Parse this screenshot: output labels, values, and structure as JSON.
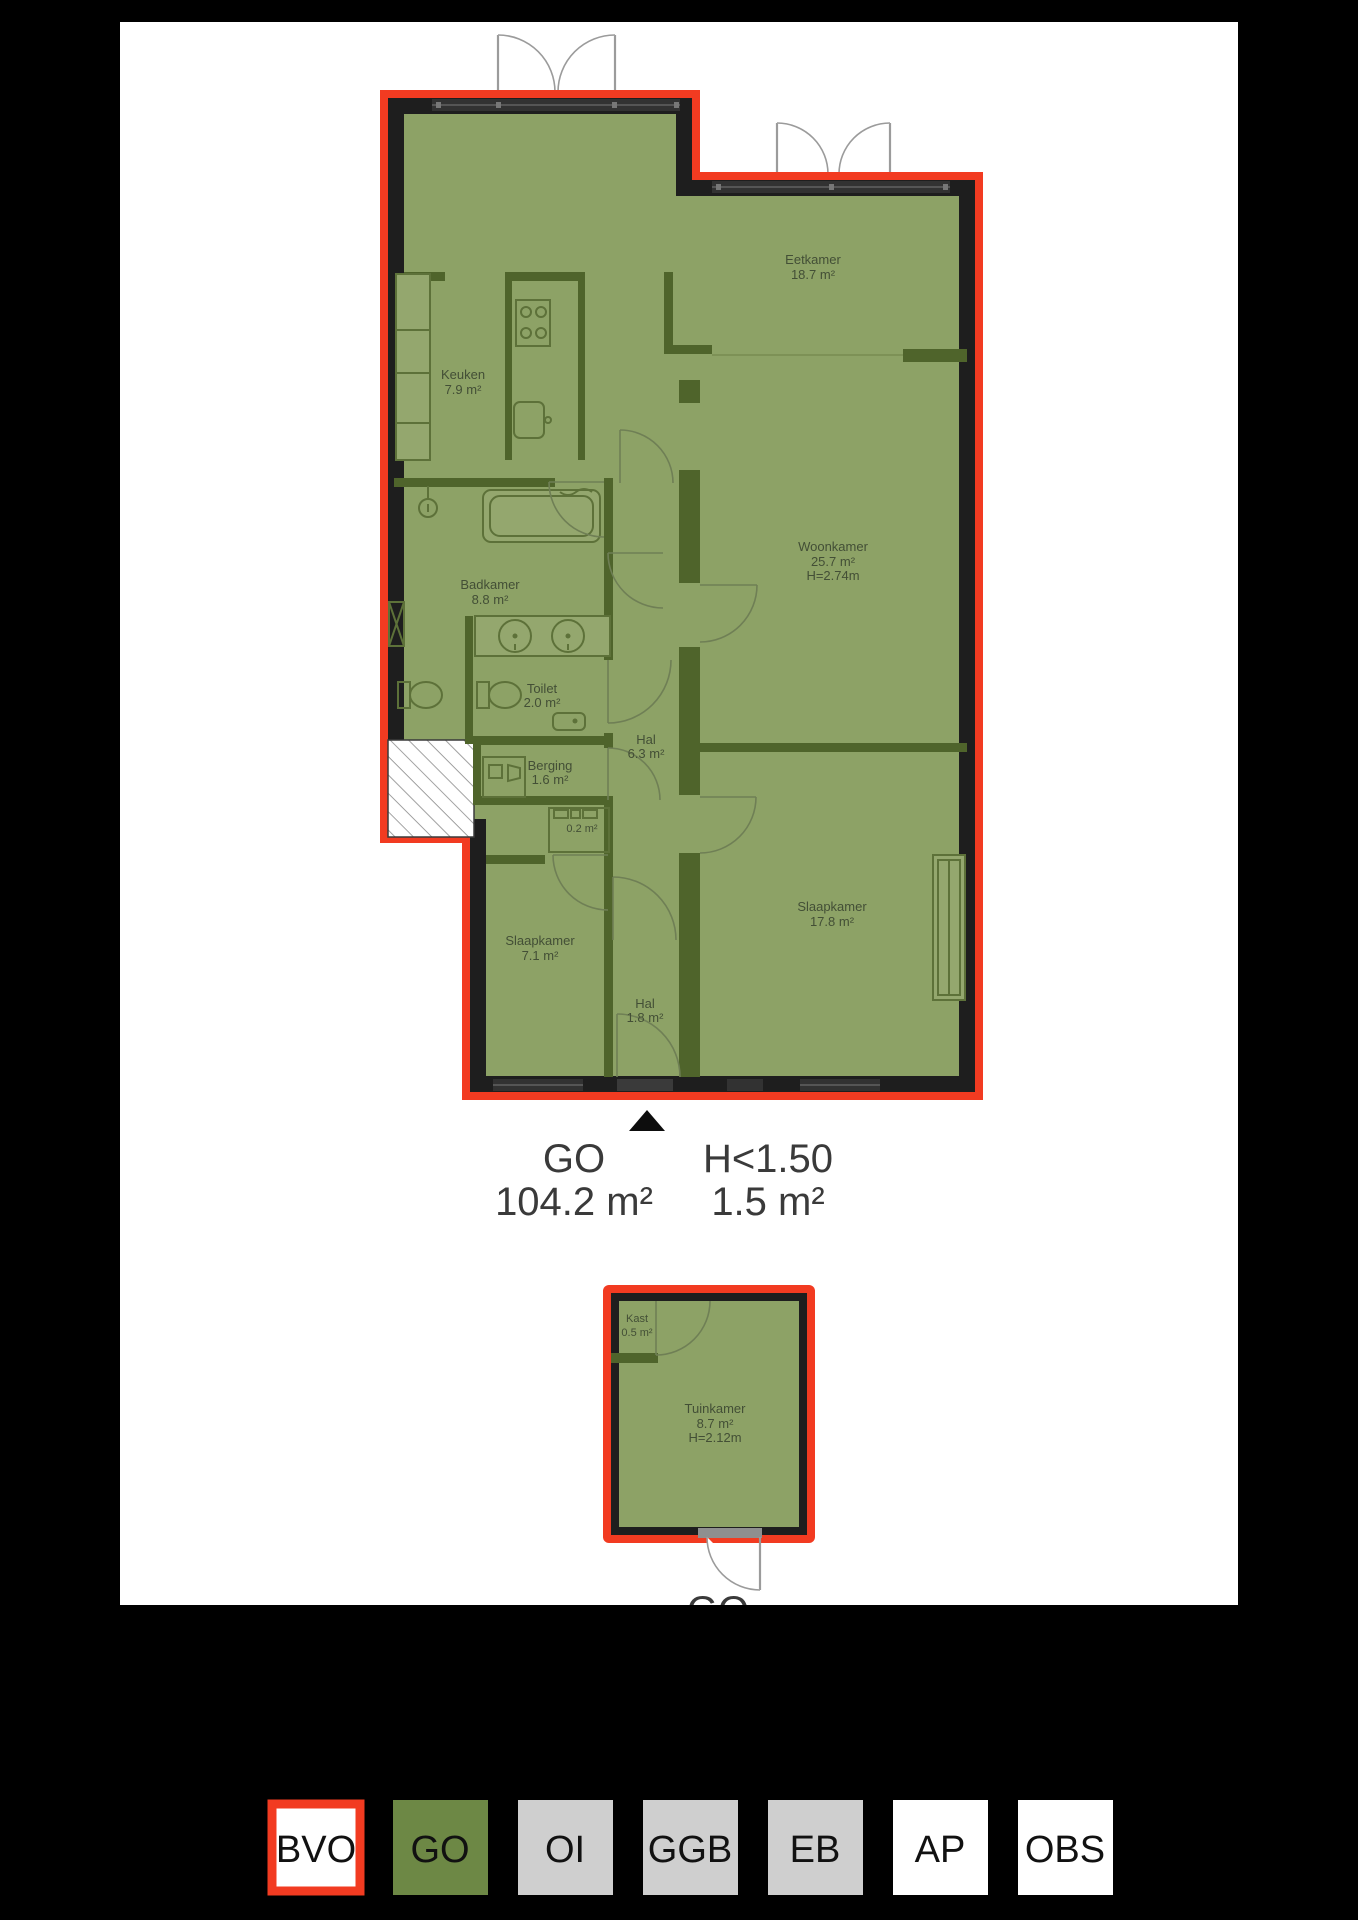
{
  "colors": {
    "background": "#000000",
    "page": "#ffffff",
    "bvo_red": "#f23b21",
    "go_green_legend": "#6d8845",
    "plan_fill_green": "#8da266",
    "outer_wall_black": "#1e1e1e",
    "interior_wall_olive": "#4f642b",
    "legend_gray": "#cfcfcf",
    "legend_white": "#ffffff"
  },
  "main_plan": {
    "rooms": [
      {
        "name": "Keuken",
        "area": "7.9 m²"
      },
      {
        "name": "Eetkamer",
        "area": "18.7 m²"
      },
      {
        "name": "Woonkamer",
        "area": "25.7 m²",
        "height": "H=2.74m"
      },
      {
        "name": "Badkamer",
        "area": "8.8 m²"
      },
      {
        "name": "Toilet",
        "area": "2.0 m²"
      },
      {
        "name": "Hal",
        "area": "6.3 m²"
      },
      {
        "name": "Berging",
        "area": "1.6 m²"
      },
      {
        "name": "",
        "area": "0.2 m²"
      },
      {
        "name": "Slaapkamer",
        "area": "7.1 m²"
      },
      {
        "name": "Hal",
        "area": "1.8 m²"
      },
      {
        "name": "Slaapkamer",
        "area": "17.8 m²"
      }
    ],
    "summary": {
      "go": {
        "label": "GO",
        "value": "104.2 m²"
      },
      "h150": {
        "label": "H<1.50",
        "value": "1.5 m²"
      }
    }
  },
  "secondary_plan": {
    "rooms": [
      {
        "name": "Kast",
        "area": "0.5 m²"
      },
      {
        "name": "Tuinkamer",
        "area": "8.7 m²",
        "height": "H=2.12m"
      }
    ],
    "summary": {
      "label": "GO"
    }
  },
  "legend": {
    "items": [
      {
        "label": "BVO",
        "fill": "#ffffff",
        "border": "#f23b21"
      },
      {
        "label": "GO",
        "fill": "#6d8845"
      },
      {
        "label": "OI",
        "fill": "#cfcfcf"
      },
      {
        "label": "GGB",
        "fill": "#cfcfcf"
      },
      {
        "label": "EB",
        "fill": "#cfcfcf"
      },
      {
        "label": "AP",
        "fill": "#ffffff"
      },
      {
        "label": "OBS",
        "fill": "#ffffff"
      }
    ]
  }
}
